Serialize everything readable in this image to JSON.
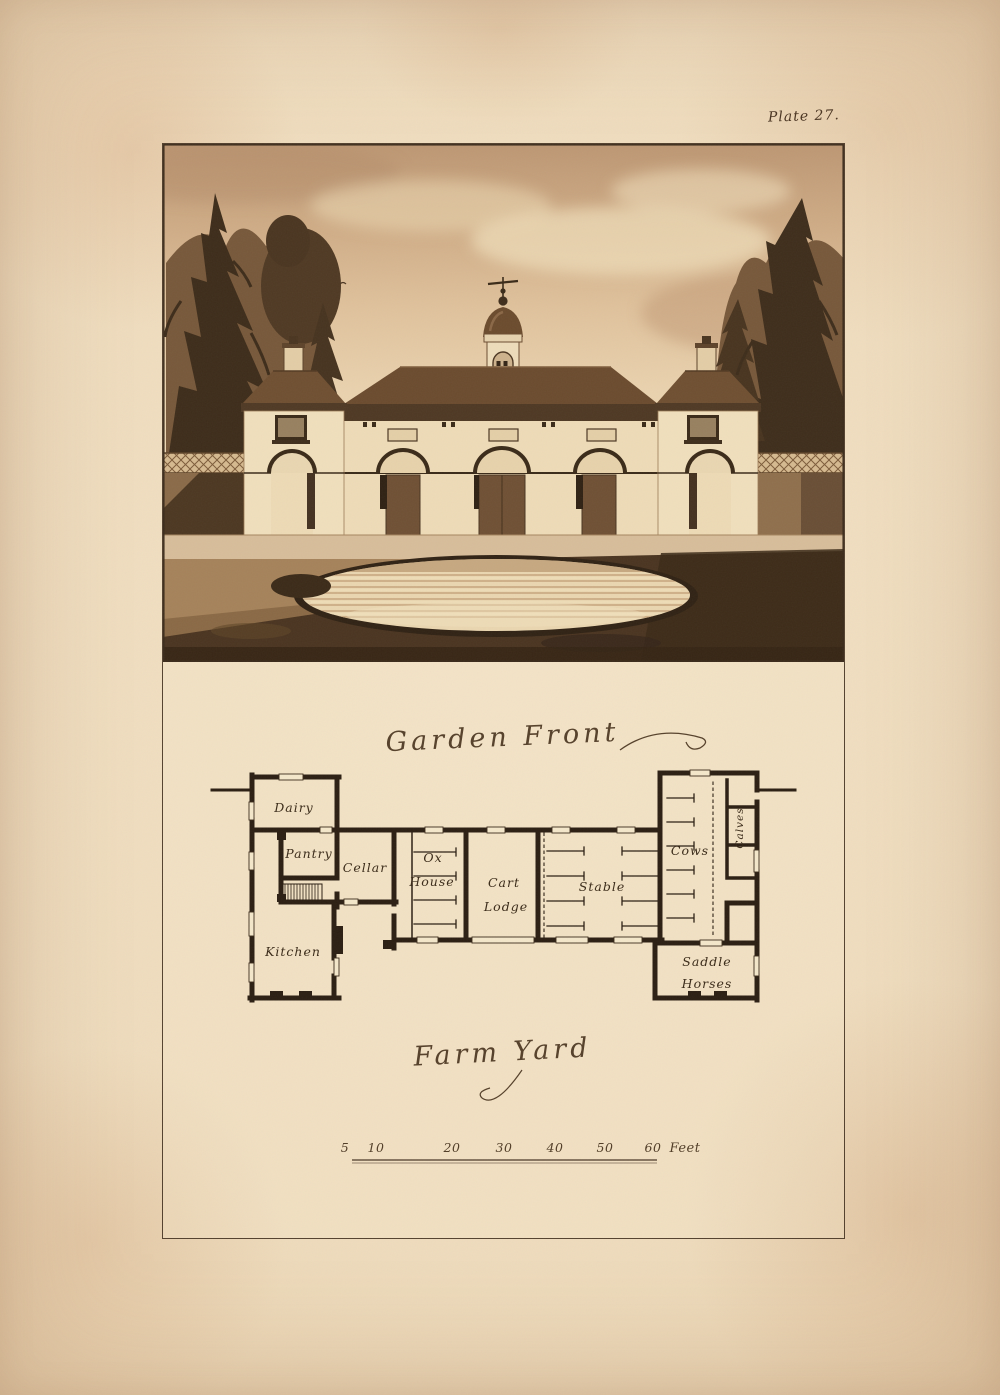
{
  "plate": {
    "number_label": "Plate 27."
  },
  "titles": {
    "elevation": "Garden Front",
    "plan": "Farm Yard"
  },
  "plan": {
    "rooms": {
      "dairy": "Dairy",
      "pantry": "Pantry",
      "cellar": "Cellar",
      "kitchen": "Kitchen",
      "ox_house": [
        "Ox",
        "House"
      ],
      "cart_lodge": [
        "Cart",
        "Lodge"
      ],
      "stable": "Stable",
      "cows": "Cows",
      "calves": "Calves",
      "saddle_horses": [
        "Saddle",
        "Horses"
      ]
    }
  },
  "scale_bar": {
    "ticks": [
      "5",
      "10",
      "20",
      "30",
      "40",
      "50",
      "60"
    ],
    "unit": "Feet"
  },
  "colors": {
    "paper": "#eed9ba",
    "ink": "#2b1e12",
    "sepia_dark": "#3d2c1a",
    "sepia_mid": "#8a6a48",
    "wall_cream": "#ecd9b6",
    "script": "#55402a"
  }
}
